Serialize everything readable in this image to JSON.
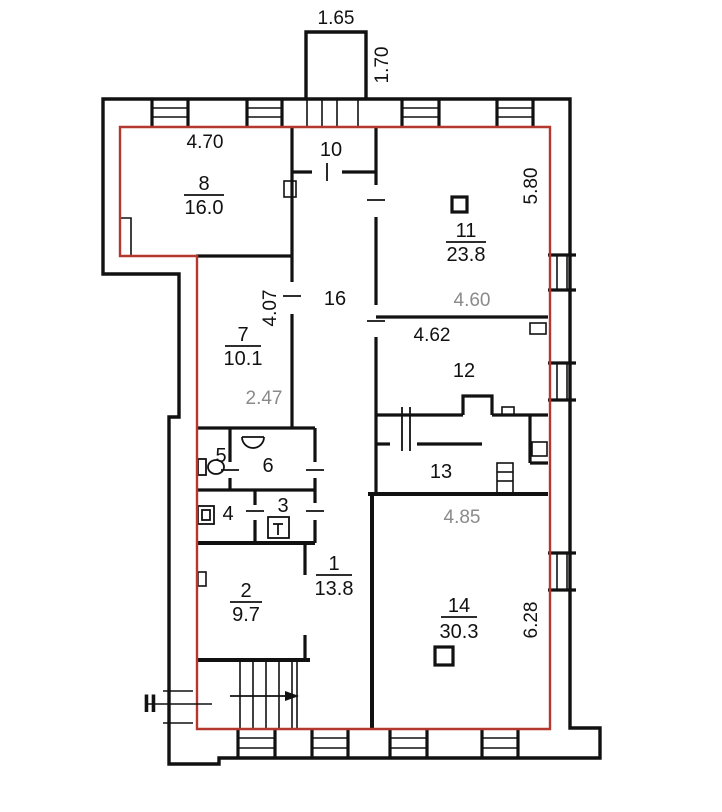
{
  "plan": {
    "unit_outline_color": "#b4382f",
    "dim_muted_color": "#8a8a8a",
    "section_marker": {
      "label": "II",
      "color": "#cc3333"
    },
    "rooms": [
      {
        "id": "8",
        "number": "8",
        "area": "16.0"
      },
      {
        "id": "10",
        "number": "10"
      },
      {
        "id": "11",
        "number": "11",
        "area": "23.8"
      },
      {
        "id": "16",
        "number": "16"
      },
      {
        "id": "7",
        "number": "7",
        "area": "10.1"
      },
      {
        "id": "12",
        "number": "12"
      },
      {
        "id": "13",
        "number": "13"
      },
      {
        "id": "5",
        "number": "5"
      },
      {
        "id": "6",
        "number": "6"
      },
      {
        "id": "4",
        "number": "4"
      },
      {
        "id": "3",
        "number": "3"
      },
      {
        "id": "2",
        "number": "2",
        "area": "9.7"
      },
      {
        "id": "1",
        "number": "1",
        "area": "13.8"
      },
      {
        "id": "14",
        "number": "14",
        "area": "30.3"
      }
    ],
    "dimensions": [
      {
        "text": "1.65"
      },
      {
        "text": "1.70"
      },
      {
        "text": "4.70"
      },
      {
        "text": "5.80"
      },
      {
        "text": "4.07"
      },
      {
        "text": "4.60"
      },
      {
        "text": "4.62"
      },
      {
        "text": "2.47"
      },
      {
        "text": "4.85"
      },
      {
        "text": "6.28"
      }
    ]
  }
}
